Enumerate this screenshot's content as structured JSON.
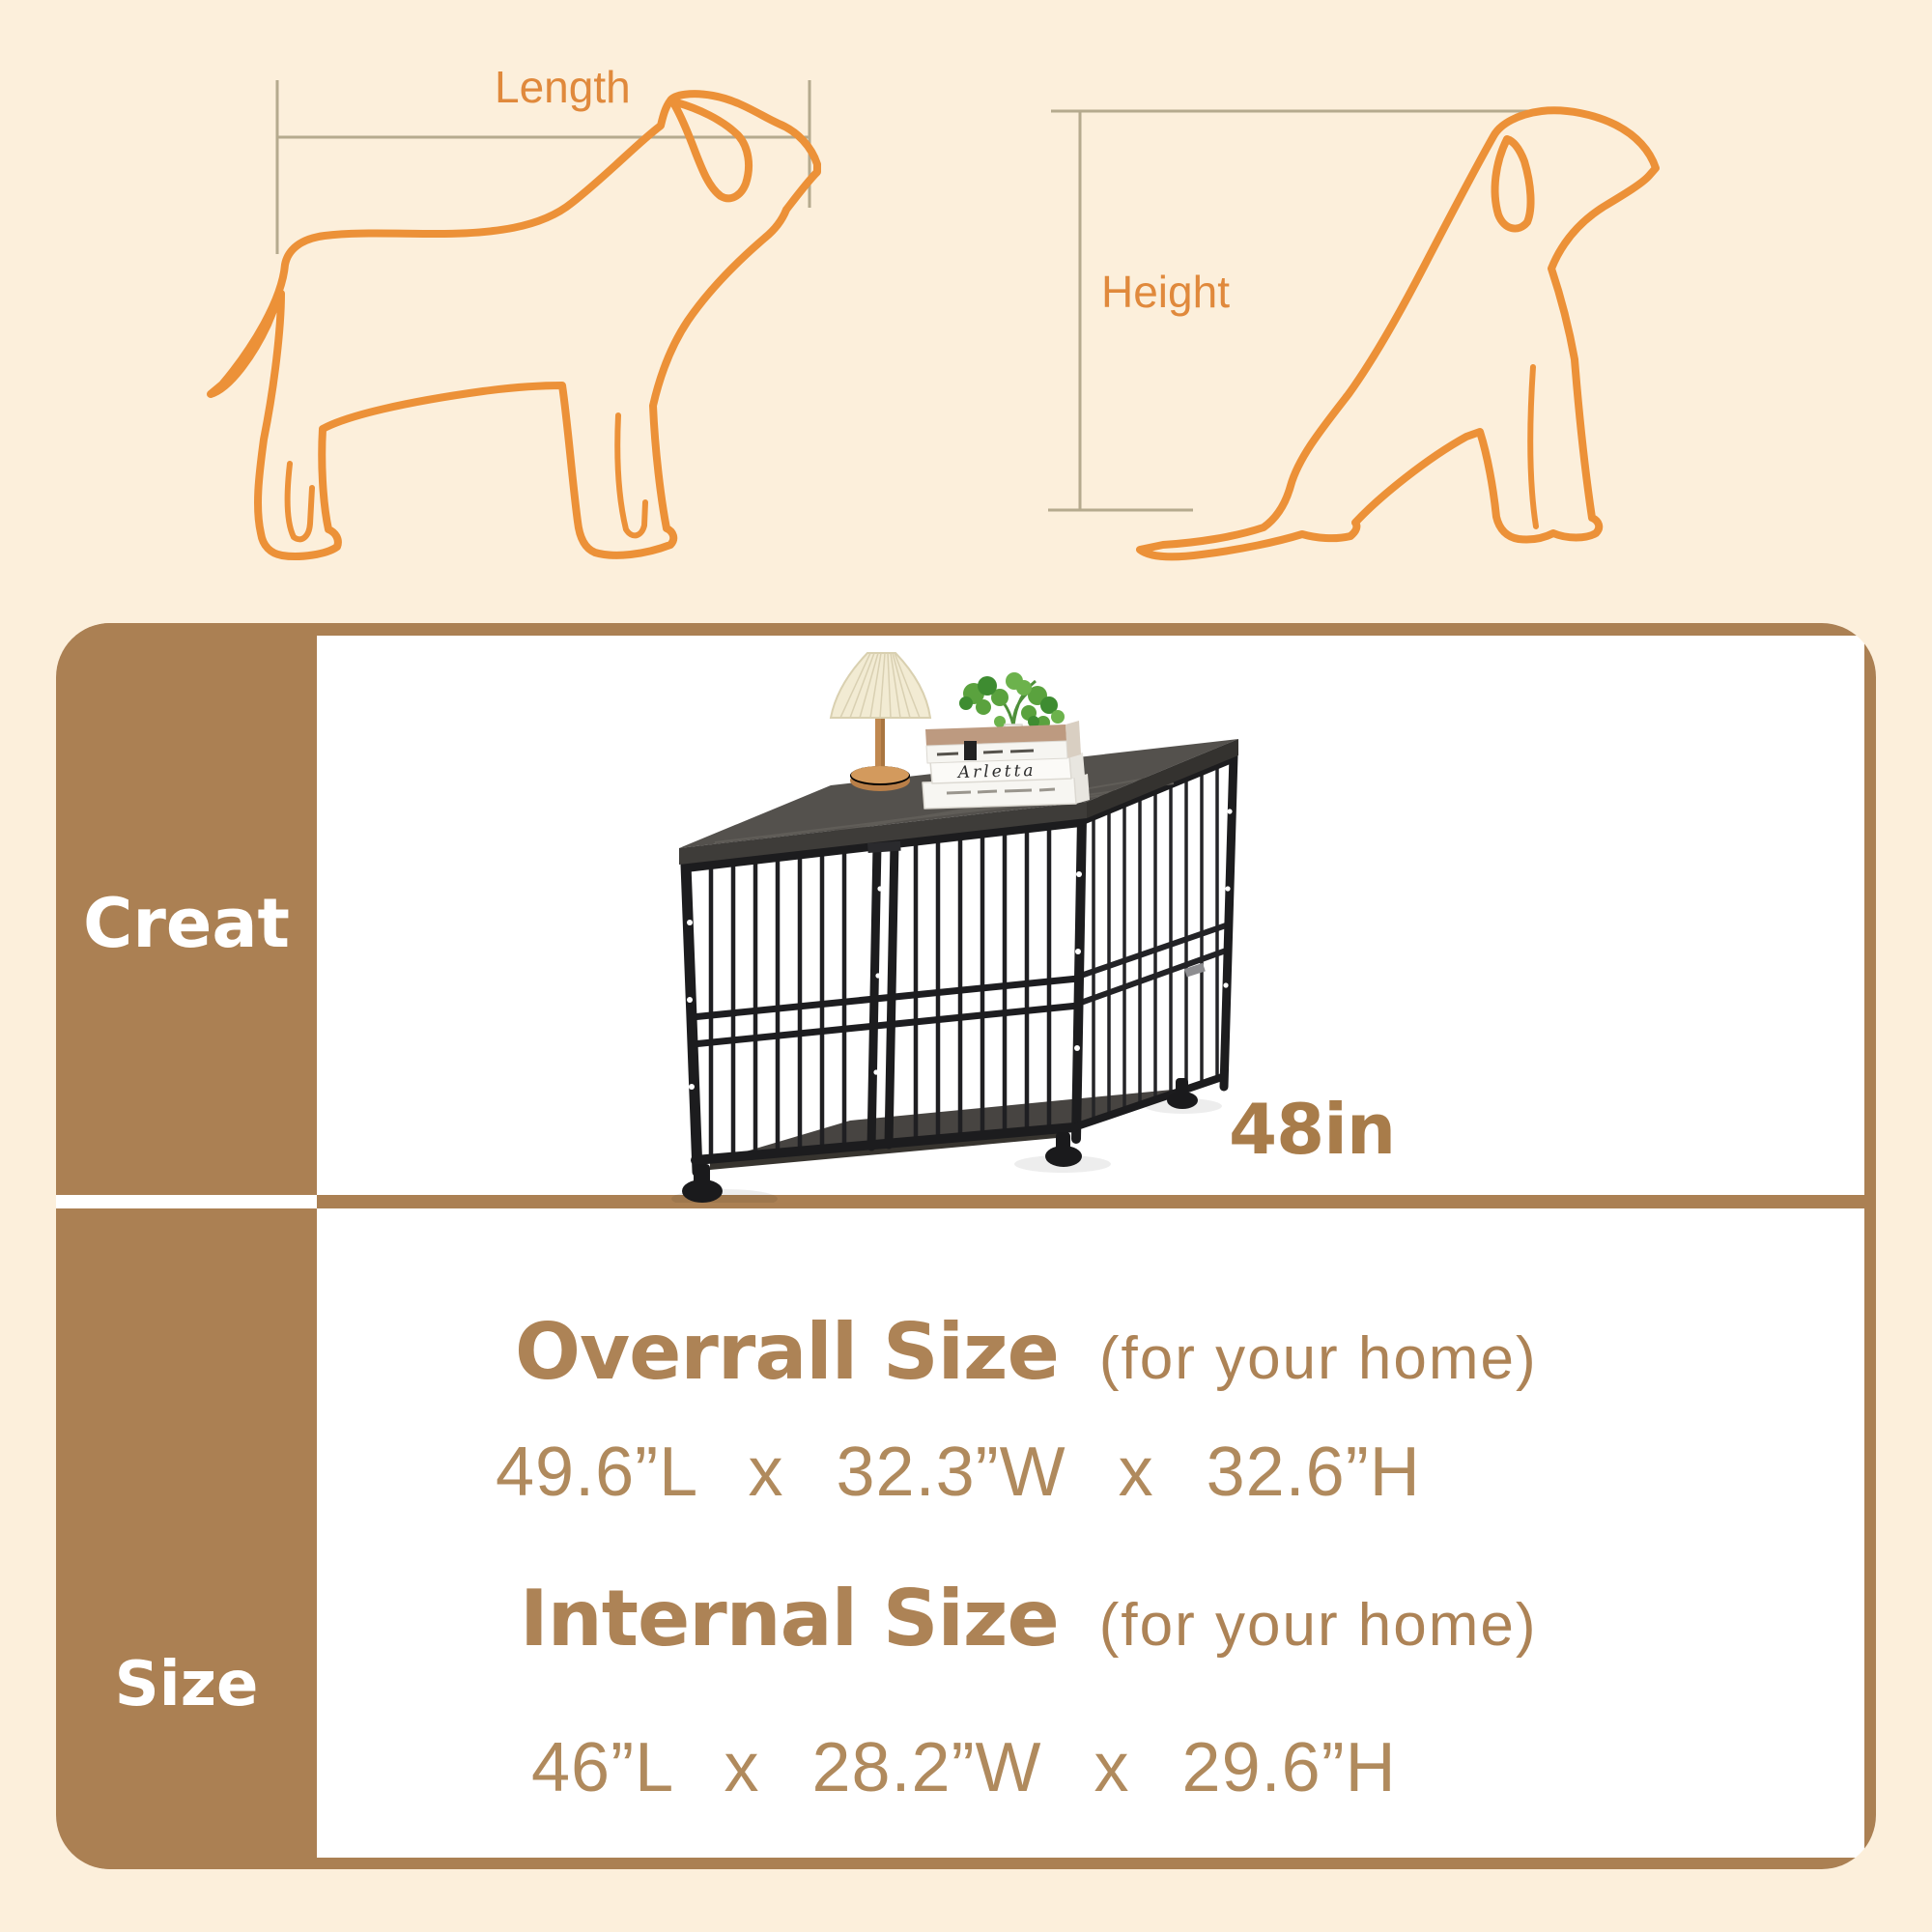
{
  "diagram": {
    "length_label": "Length",
    "height_label": "Height",
    "outline_color": "#ec9138",
    "label_color": "#e0893c",
    "measure_line_color": "#b5aa8e"
  },
  "panel": {
    "accent_color": "#ab8053",
    "background_color": "#fcefdb",
    "row1_label": "Creat",
    "row2_label": "Size",
    "size_tag": "48in"
  },
  "product": {
    "book_title": "Arletta"
  },
  "sizes": {
    "overall_title": "Overrall Size",
    "overall_note": "(for your home)",
    "overall_dims": "49.6”L  x  32.3”W  x  32.6”H",
    "internal_title": "Internal Size",
    "internal_note": "(for your home)",
    "internal_dims": "46”L  x  28.2”W  x  29.6”H"
  }
}
